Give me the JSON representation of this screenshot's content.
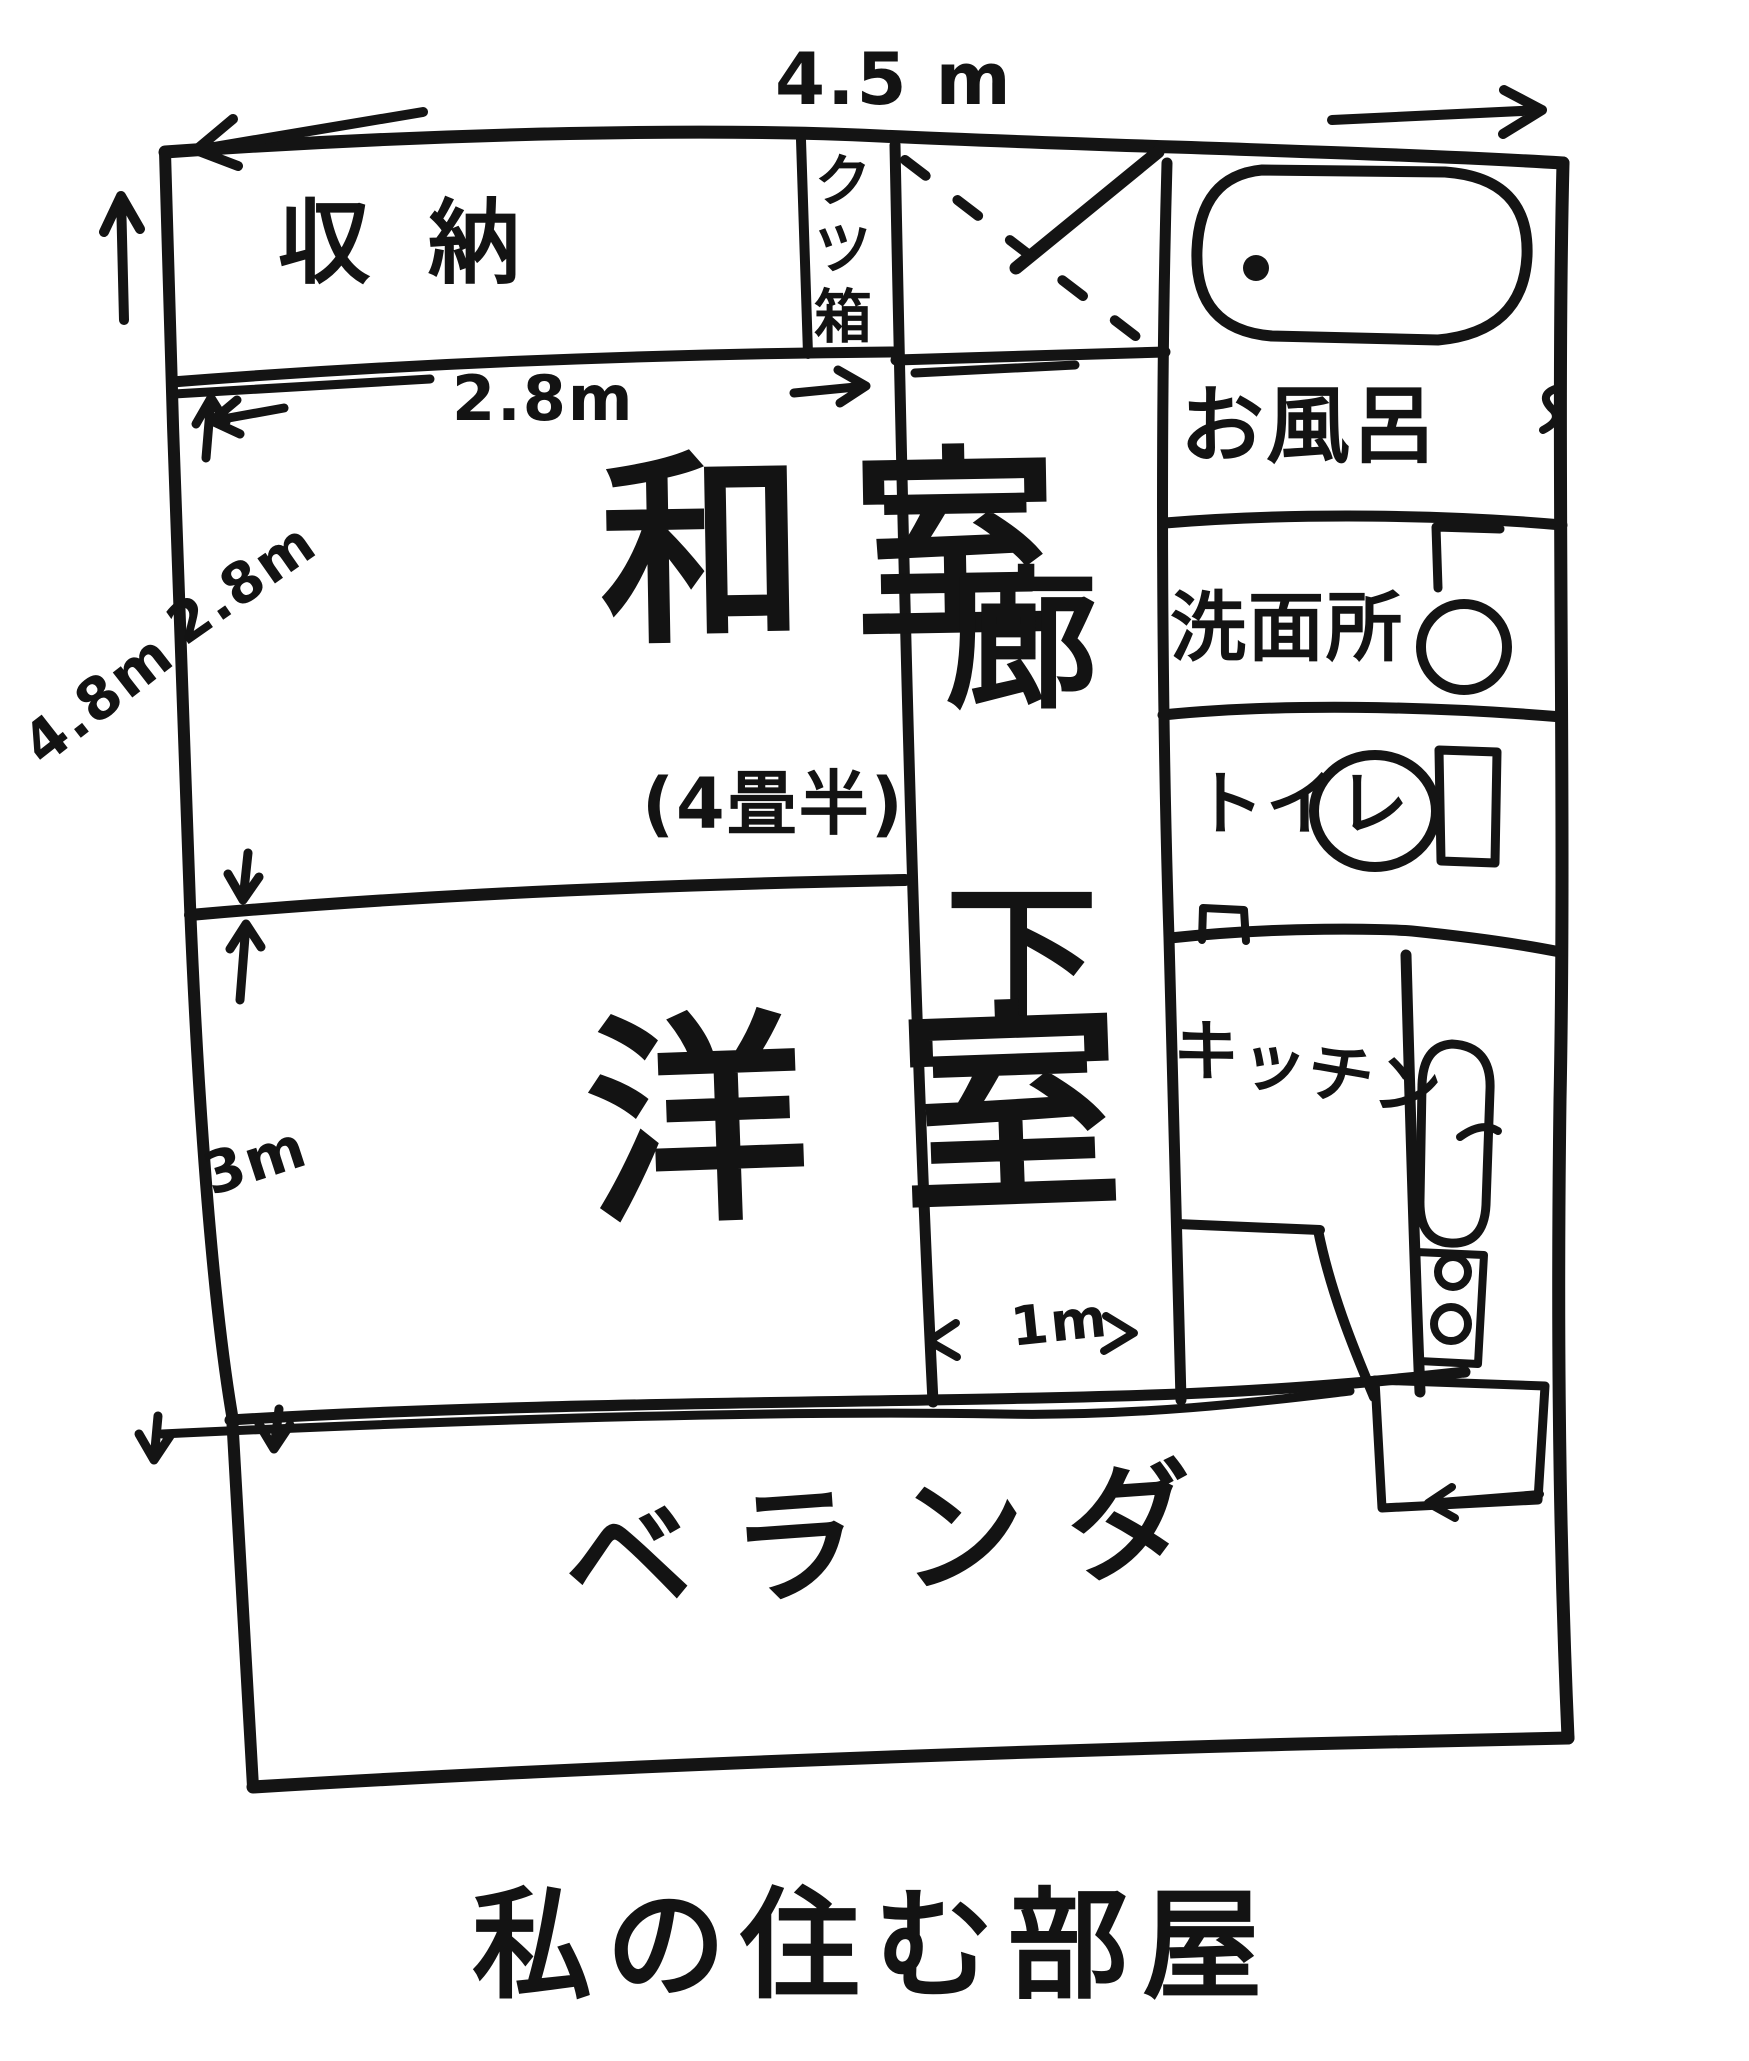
{
  "title": "私の住む部屋",
  "dims": {
    "top_width": "4.5 m",
    "left_height": "4.8m",
    "closet_width": "2.8m",
    "washitsu_height": "2.8m",
    "youshitsu_height": "3m",
    "corridor_width": "1m"
  },
  "rooms": {
    "closet": "収納",
    "shoebox": "クツ箱",
    "washitsu": "和室",
    "washitsu_size": "(4畳半)",
    "corridor": "廊下",
    "bath": "お風呂",
    "washroom": "洗面所",
    "toilet": "トイレ",
    "kitchen": "キッチン",
    "youshitsu": "洋室",
    "veranda": "ベランダ"
  },
  "colors": {
    "ink": "#141414",
    "paper": "#ffffff"
  }
}
